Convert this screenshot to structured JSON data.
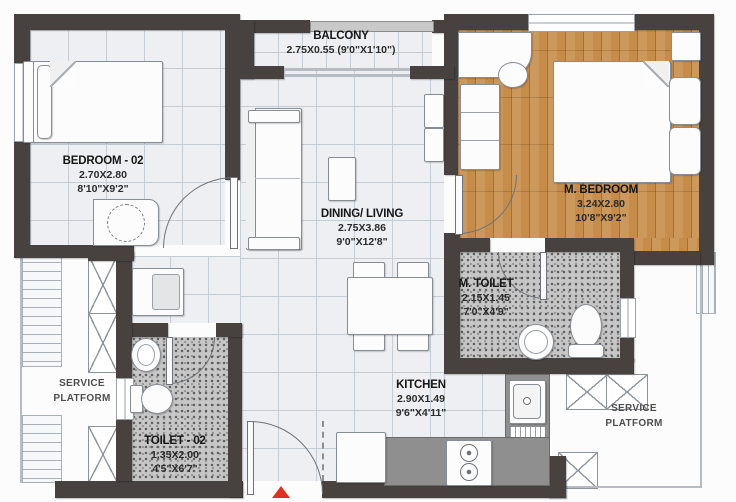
{
  "palette": {
    "wall": "#474240",
    "wood_floor": "#c68c49",
    "tile_floor": "#edeff2",
    "toilet_floor": "#c6c6c6",
    "counter": "#8f8f8f",
    "entry_arrow": "#e0301e"
  },
  "rooms": {
    "balcony": {
      "name": "BALCONY",
      "dims": "2.75X0.55 (9'0\"X1'10\")"
    },
    "bedroom2": {
      "name": "BEDROOM - 02",
      "dims_m": "2.70X2.80",
      "dims_ft": "8'10\"X9'2\""
    },
    "master_bedroom": {
      "name": "M. BEDROOM",
      "dims_m": "3.24X2.80",
      "dims_ft": "10'8\"X9'2\""
    },
    "dining_living": {
      "name": "DINING/ LIVING",
      "dims_m": "2.75X3.86",
      "dims_ft": "9'0\"X12'8\""
    },
    "master_toilet": {
      "name": "M. TOILET",
      "dims_m": "2.15X1.45",
      "dims_ft": "7'0\"X4'9\""
    },
    "kitchen": {
      "name": "KITCHEN",
      "dims_m": "2.90X1.49",
      "dims_ft": "9'6\"X4'11\""
    },
    "toilet2": {
      "name": "TOILET - 02",
      "dims_m": "1.35X2.00",
      "dims_ft": "4'5\"X6'7\""
    },
    "service_left": {
      "line1": "SERVICE",
      "line2": "PLATFORM"
    },
    "service_right": {
      "line1": "SERVICE",
      "line2": "PLATFORM"
    }
  }
}
